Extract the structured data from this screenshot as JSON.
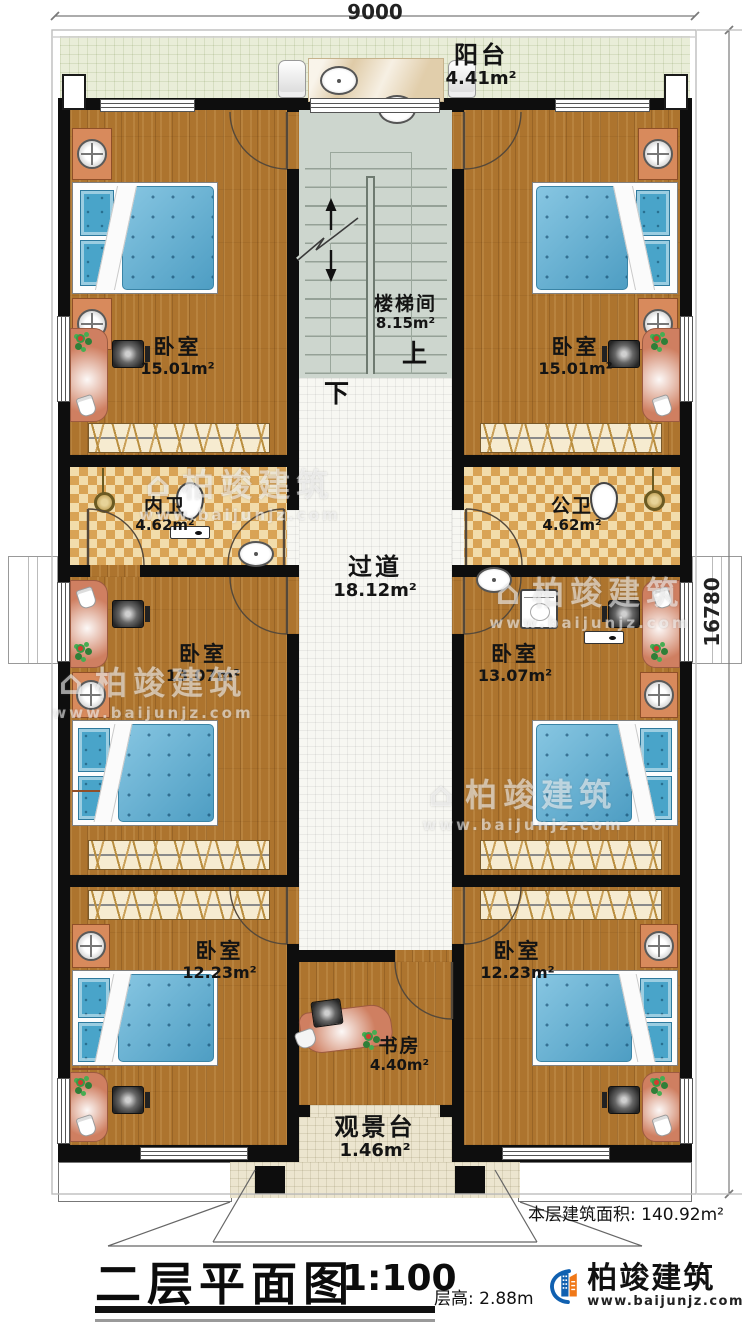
{
  "dims": {
    "top": "9000",
    "right": "16780"
  },
  "rooms": {
    "balcony": {
      "name": "阳台",
      "area": "4.41m²"
    },
    "stairwell": {
      "name": "楼梯间",
      "area": "8.15m²",
      "up": "上",
      "down": "下"
    },
    "bedroom_tl": {
      "name": "卧室",
      "area": "15.01m²"
    },
    "bedroom_tr": {
      "name": "卧室",
      "area": "15.01m²"
    },
    "bath_left": {
      "name": "内卫",
      "area": "4.62m²"
    },
    "bath_right": {
      "name": "公卫",
      "area": "4.62m²"
    },
    "corridor": {
      "name": "过道",
      "area": "18.12m²"
    },
    "bedroom_ml": {
      "name": "卧室",
      "area": "13.07m²"
    },
    "bedroom_mr": {
      "name": "卧室",
      "area": "13.07m²"
    },
    "bedroom_bl": {
      "name": "卧室",
      "area": "12.23m²"
    },
    "bedroom_br": {
      "name": "卧室",
      "area": "12.23m²"
    },
    "study": {
      "name": "书房",
      "area": "4.40m²"
    },
    "deck": {
      "name": "观景台",
      "area": "1.46m²"
    }
  },
  "notes": {
    "floor_area": "本层建筑面积: 140.92m²",
    "floor_height": "层高: 2.88m"
  },
  "title": {
    "text": "二层平面图",
    "scale": "1:100"
  },
  "brand": {
    "name": "柏竣建筑",
    "url": "www.baijunjz.com"
  },
  "watermark": {
    "glyph": "⌂",
    "brand": "柏竣建筑",
    "url": "www.baijunjz.com"
  },
  "colors": {
    "wall": "#0e0e0e",
    "wood": "#ad742e",
    "stair": "#cdd6ce",
    "checker_light": "#f2dcab",
    "checker_dark": "#d9a355",
    "bed_blue": "#5fb3d8",
    "brand_blue": "#1060b0",
    "brand_orange": "#f07818"
  }
}
